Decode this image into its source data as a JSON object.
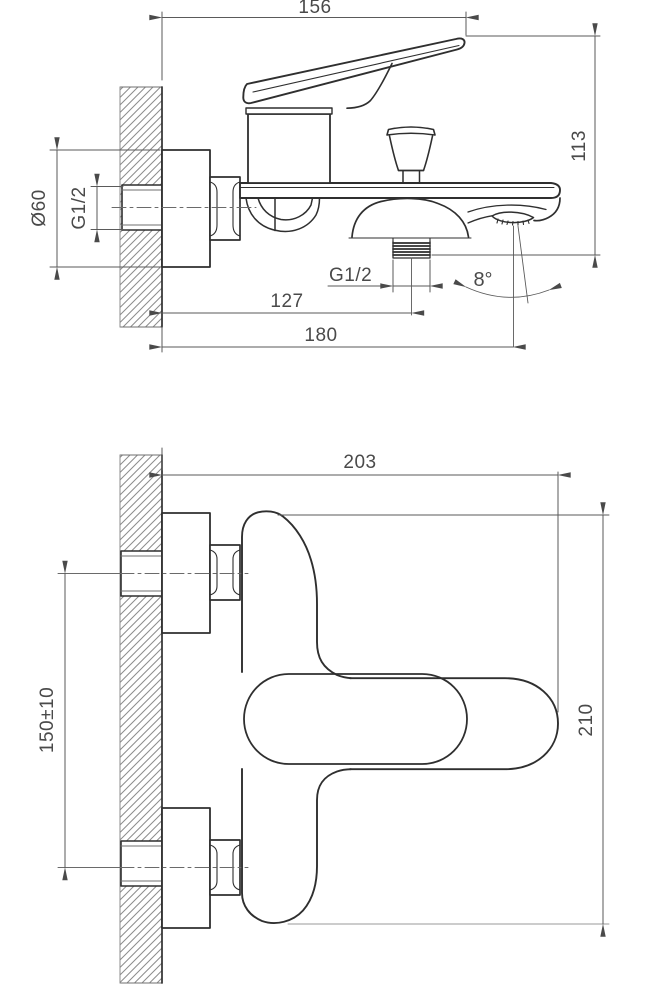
{
  "drawing": {
    "type": "technical-drawing",
    "subject": "wall-mounted bath mixer faucet, two orthographic views with dimensions",
    "units": "mm",
    "side_view": {
      "handle_reach": "156",
      "height_deck_to_handle": "113",
      "escutcheon_diameter": "Ø60",
      "wall_inlet_thread": "G1/2",
      "bottom_outlet_thread": "G1/2",
      "spout_angle": "8°",
      "wall_to_outlet": "127",
      "wall_to_spout_tip": "180"
    },
    "front_view": {
      "total_width": "203",
      "total_height": "210",
      "inlet_spacing": "150±10"
    },
    "colors": {
      "background": "#ffffff",
      "object_line": "#2f2f2f",
      "dimension_line": "#5a5a5a",
      "text": "#4a4a4a",
      "hatch": "#8c8c8c"
    }
  }
}
